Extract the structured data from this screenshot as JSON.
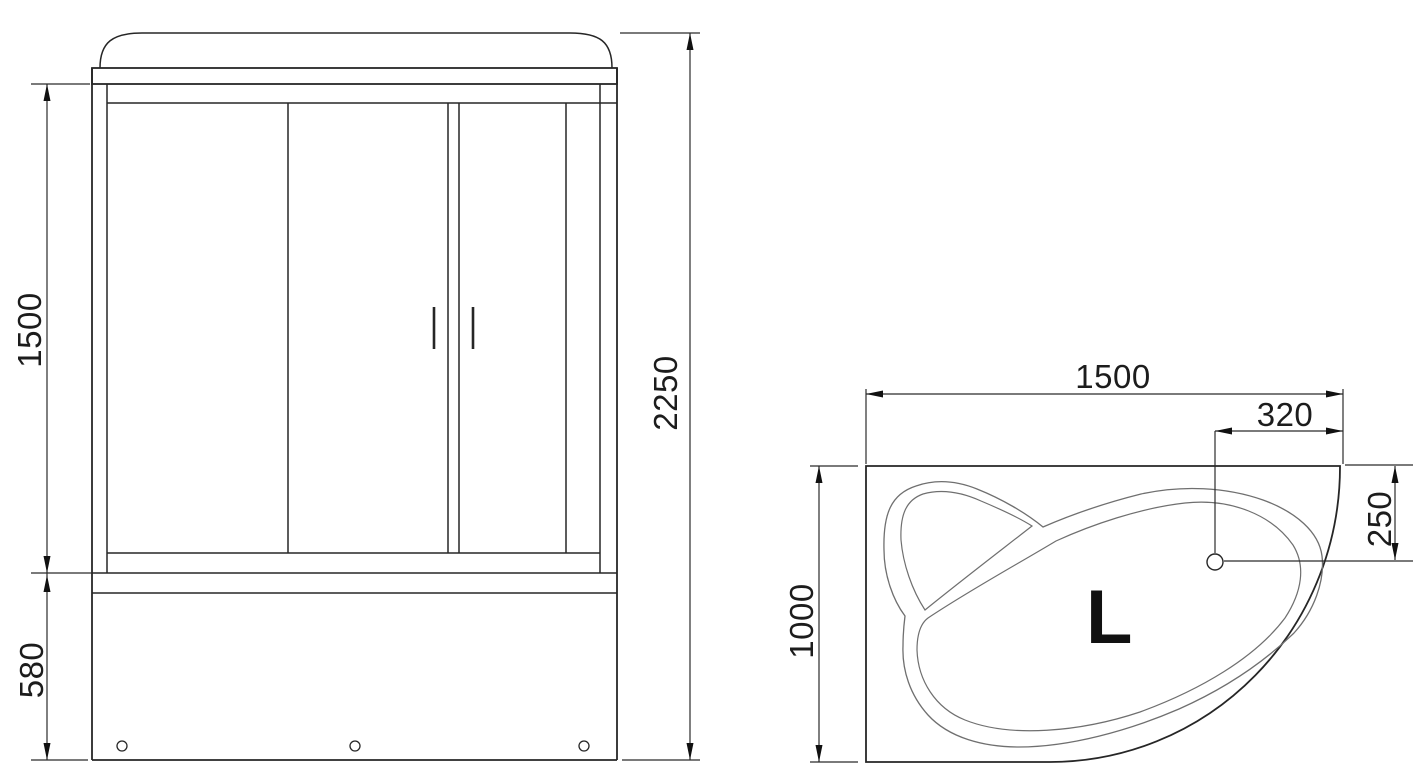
{
  "drawing": {
    "kind": "shower-cabin-with-corner-bathtub-technical-drawing",
    "front_view": {
      "label": "front elevation of shower cabin",
      "dimensions": {
        "glass_section_height": "1500",
        "tray_height": "580",
        "total_height": "2250"
      }
    },
    "top_view": {
      "label": "plan view of corner bathtub",
      "dimensions": {
        "width": "1500",
        "depth": "1000",
        "drain_offset_from_right": "320",
        "drain_offset_from_top": "250"
      },
      "orientation_label": "L"
    },
    "colors": {
      "main_line": "#262626",
      "thin_line": "#6f6f6f",
      "dim_line": "#2b2b2b",
      "background": "#ffffff"
    }
  }
}
